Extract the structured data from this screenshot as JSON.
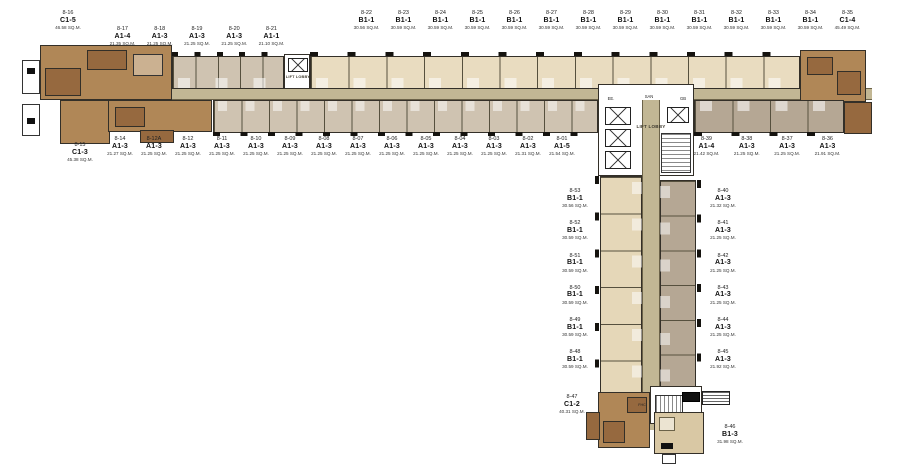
{
  "colors": {
    "corridor": "#c2b794",
    "cream": "#e9dcc0",
    "taupe": "#cfc3b1",
    "taupeDark": "#b5a794",
    "wingCream": "#e5d7b8",
    "brown": "#b08757",
    "brownDark": "#96693f",
    "beige": "#d9c8a4",
    "wall": "#332f28",
    "ink": "#1d1d1d"
  },
  "core": {
    "lift_lobby": "LIFT LOBBY",
    "lift_lobby_left": "LIFT LOBBY",
    "ee": "EE.",
    "san": "SAN",
    "gb": "GB",
    "fhc": "FHC"
  },
  "units": {
    "top_left_corner": {
      "id": "8-16",
      "type": "C1-5",
      "area": "46.58 SQ.M."
    },
    "top_left_row": [
      {
        "id": "8-17",
        "type": "A1-4",
        "area": "21.35 SQ.M."
      },
      {
        "id": "8-18",
        "type": "A1-3",
        "area": "21.25 SQ.M."
      },
      {
        "id": "8-19",
        "type": "A1-3",
        "area": "21.25 SQ.M."
      },
      {
        "id": "8-20",
        "type": "A1-3",
        "area": "21.25 SQ.M."
      },
      {
        "id": "8-21",
        "type": "A1-1",
        "area": "21.10 SQ.M."
      }
    ],
    "top_row": [
      {
        "id": "8-22",
        "type": "B1-1",
        "area": "30.56 SQ.M."
      },
      {
        "id": "8-23",
        "type": "B1-1",
        "area": "30.59 SQ.M."
      },
      {
        "id": "8-24",
        "type": "B1-1",
        "area": "30.59 SQ.M."
      },
      {
        "id": "8-25",
        "type": "B1-1",
        "area": "30.59 SQ.M."
      },
      {
        "id": "8-26",
        "type": "B1-1",
        "area": "30.59 SQ.M."
      },
      {
        "id": "8-27",
        "type": "B1-1",
        "area": "30.59 SQ.M."
      },
      {
        "id": "8-28",
        "type": "B1-1",
        "area": "30.59 SQ.M."
      },
      {
        "id": "8-29",
        "type": "B1-1",
        "area": "30.59 SQ.M."
      },
      {
        "id": "8-30",
        "type": "B1-1",
        "area": "30.59 SQ.M."
      },
      {
        "id": "8-31",
        "type": "B1-1",
        "area": "30.59 SQ.M."
      },
      {
        "id": "8-32",
        "type": "B1-1",
        "area": "30.59 SQ.M."
      },
      {
        "id": "8-33",
        "type": "B1-1",
        "area": "30.59 SQ.M."
      },
      {
        "id": "8-34",
        "type": "B1-1",
        "area": "30.59 SQ.M."
      },
      {
        "id": "8-35",
        "type": "C1-4",
        "area": "45.49 SQ.M."
      }
    ],
    "bottom_left_corner": {
      "id": "8-15",
      "type": "C1-3",
      "area": "45.38 SQ.M."
    },
    "bottom_row": [
      {
        "id": "8-14",
        "type": "A1-3",
        "area": "21.27 SQ.M."
      },
      {
        "id": "8-12A",
        "type": "A1-3",
        "area": "21.25 SQ.M."
      },
      {
        "id": "8-12",
        "type": "A1-3",
        "area": "21.25 SQ.M."
      },
      {
        "id": "8-11",
        "type": "A1-3",
        "area": "21.25 SQ.M."
      },
      {
        "id": "8-10",
        "type": "A1-3",
        "area": "21.25 SQ.M."
      },
      {
        "id": "8-09",
        "type": "A1-3",
        "area": "21.25 SQ.M."
      },
      {
        "id": "8-08",
        "type": "A1-3",
        "area": "21.25 SQ.M."
      },
      {
        "id": "8-07",
        "type": "A1-3",
        "area": "21.25 SQ.M."
      },
      {
        "id": "8-06",
        "type": "A1-3",
        "area": "21.25 SQ.M."
      },
      {
        "id": "8-05",
        "type": "A1-3",
        "area": "21.25 SQ.M."
      },
      {
        "id": "8-04",
        "type": "A1-3",
        "area": "21.25 SQ.M."
      },
      {
        "id": "8-03",
        "type": "A1-3",
        "area": "21.25 SQ.M."
      },
      {
        "id": "8-02",
        "type": "A1-3",
        "area": "21.31 SQ.M."
      },
      {
        "id": "8-01",
        "type": "A1-5",
        "area": "21.54 SQ.M."
      }
    ],
    "bottom_right_row": [
      {
        "id": "8-39",
        "type": "A1-4",
        "area": "21.42 SQ.M."
      },
      {
        "id": "8-38",
        "type": "A1-3",
        "area": "21.25 SQ.M."
      },
      {
        "id": "8-37",
        "type": "A1-3",
        "area": "21.25 SQ.M."
      },
      {
        "id": "8-36",
        "type": "A1-3",
        "area": "21.91 SQ.M."
      }
    ],
    "wing_left_col": [
      {
        "id": "8-53",
        "type": "B1-1",
        "area": "30.56 SQ.M."
      },
      {
        "id": "8-52",
        "type": "B1-1",
        "area": "30.59 SQ.M."
      },
      {
        "id": "8-51",
        "type": "B1-1",
        "area": "30.59 SQ.M."
      },
      {
        "id": "8-50",
        "type": "B1-1",
        "area": "30.59 SQ.M."
      },
      {
        "id": "8-49",
        "type": "B1-1",
        "area": "30.59 SQ.M."
      },
      {
        "id": "8-48",
        "type": "B1-1",
        "area": "30.59 SQ.M."
      }
    ],
    "wing_left_corner": {
      "id": "8-47",
      "type": "C1-2",
      "area": "40.31 SQ.M."
    },
    "wing_right_col": [
      {
        "id": "8-40",
        "type": "A1-3",
        "area": "21.32 SQ.M."
      },
      {
        "id": "8-41",
        "type": "A1-3",
        "area": "21.25 SQ.M."
      },
      {
        "id": "8-42",
        "type": "A1-3",
        "area": "21.25 SQ.M."
      },
      {
        "id": "8-43",
        "type": "A1-3",
        "area": "21.25 SQ.M."
      },
      {
        "id": "8-44",
        "type": "A1-3",
        "area": "21.25 SQ.M."
      },
      {
        "id": "8-45",
        "type": "A1-3",
        "area": "21.92 SQ.M."
      }
    ],
    "wing_bottom_unit": {
      "id": "8-46",
      "type": "B1-3",
      "area": "31.98 SQ.M."
    }
  }
}
